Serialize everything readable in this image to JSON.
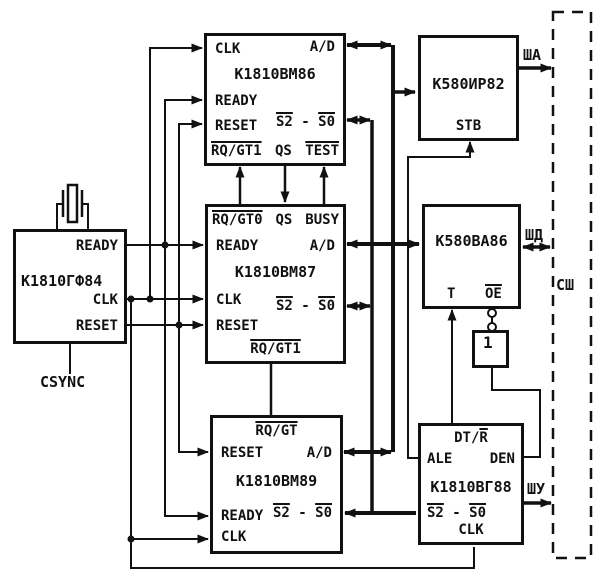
{
  "diagram": {
    "description": "K1810 (i8086-family) microprocessor system block diagram",
    "colors": {
      "ink": "#111111",
      "background": "#ffffff"
    }
  },
  "blocks": {
    "vm86": {
      "title": "К1810ВМ86",
      "pins": {
        "clk": "CLK",
        "ad": "A/D",
        "ready": "READY",
        "reset": "RESET",
        "s2": "S2",
        "sep": " - ",
        "s0": "S0",
        "rqgt1": "RQ/GT1",
        "qs": "QS",
        "test": "TEST"
      }
    },
    "vm87": {
      "title": "К1810ВМ87",
      "pins": {
        "rqgt0": "RQ/GT0",
        "qs": "QS",
        "busy": "BUSY",
        "ready": "READY",
        "ad": "A/D",
        "clk": "CLK",
        "s2": "S2",
        "sep": " - ",
        "s0": "S0",
        "reset": "RESET",
        "rqgt1": "RQ/GT1"
      }
    },
    "vm89": {
      "title": "К1810ВМ89",
      "pins": {
        "rqgt": "RQ/GT",
        "reset": "RESET",
        "ad": "A/D",
        "ready": "READY",
        "s2": "S2",
        "sep": " - ",
        "s0": "S0",
        "clk": "CLK"
      }
    },
    "gf84": {
      "title": "К1810ГФ84",
      "pins": {
        "ready": "READY",
        "clk": "CLK",
        "reset": "RESET"
      },
      "csync": "CSYNC"
    },
    "ir82": {
      "title": "К580ИР82",
      "pins": {
        "stb": "STB"
      }
    },
    "va86": {
      "title": "К580ВА86",
      "pins": {
        "t": "T",
        "oe": "OE"
      }
    },
    "vg88": {
      "title": "К1810ВГ88",
      "pins": {
        "dt": "DT/",
        "r": "R",
        "ale": "ALE",
        "den": "DEN",
        "s2": "S2",
        "sep": " - ",
        "s0": "S0",
        "clk": "CLK"
      }
    },
    "inverter": {
      "label": "1"
    }
  },
  "bus": {
    "sha": "ША",
    "shd": "ШД",
    "shu": "ШУ",
    "ssh": "СШ"
  }
}
